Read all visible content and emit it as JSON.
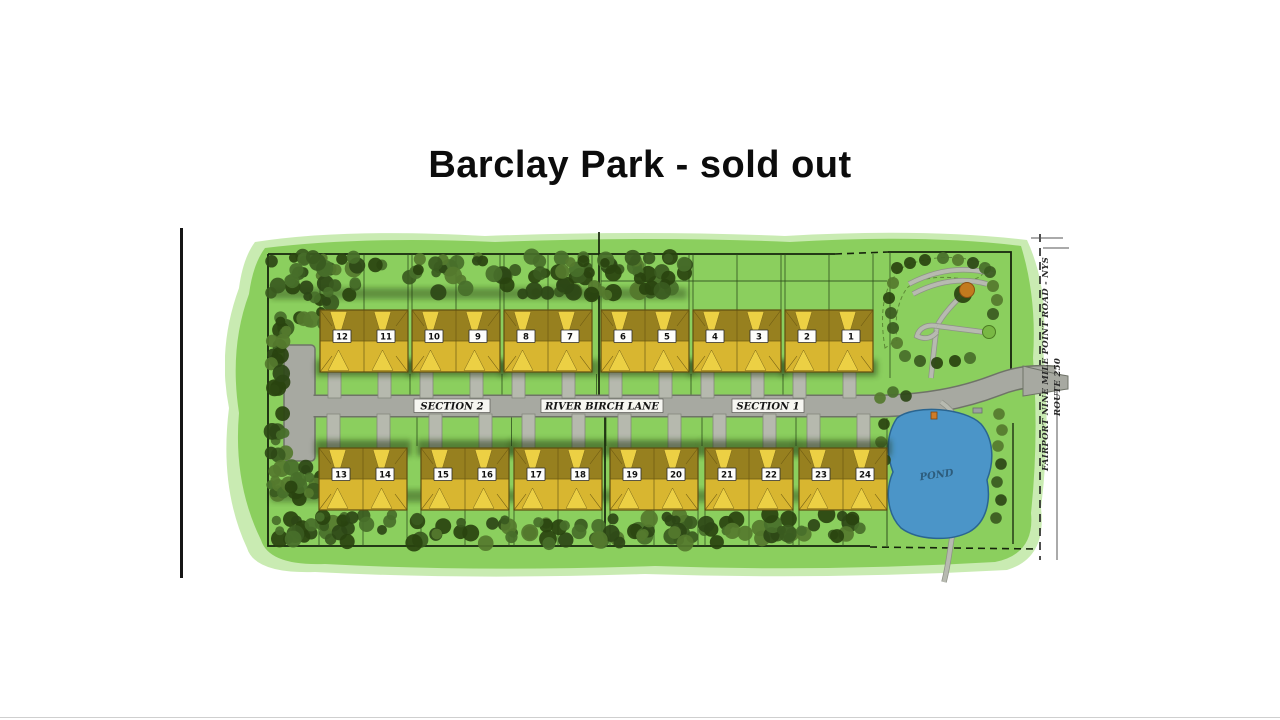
{
  "page": {
    "title": "Barclay Park -  sold out"
  },
  "map": {
    "street_label": "RIVER BIRCH LANE",
    "section_left_label": "SECTION 2",
    "section_right_label": "SECTION 1",
    "pond_label": "POND",
    "route_label_line1": "FAIRPORT NINE MILE POINT ROAD - NYS",
    "route_label_line2": "ROUTE 250",
    "buildings_top": [
      [
        12,
        11
      ],
      [
        10,
        9
      ],
      [
        8,
        7
      ],
      [
        6,
        5
      ],
      [
        4,
        3
      ],
      [
        2,
        1
      ]
    ],
    "buildings_bottom": [
      [
        13,
        14
      ],
      [
        15,
        16
      ],
      [
        17,
        18
      ],
      [
        19,
        20
      ],
      [
        21,
        22
      ],
      [
        23,
        24
      ]
    ]
  },
  "colors": {
    "grass": "#8bcf5e",
    "grass_halo": "#c6eaae",
    "road": "#a7a9a1",
    "road_edge": "#6f7368",
    "driveway": "#b6b9ae",
    "driveway_edge": "#84877c",
    "building_base": "#d8b630",
    "building_dark": "#97801f",
    "building_bright": "#ecd044",
    "building_outline": "#5f4e10",
    "pond": "#4b95c8",
    "pond_edge": "#2a6590",
    "boundary": "#16240c",
    "lot_line": "#2c4a1c",
    "shadow": "#1b310d",
    "orange_tree": "#c27a1e",
    "bush_green": "#79b844",
    "tree_greens": [
      "#2c4616",
      "#3a5a20",
      "#486f2a",
      "#29430f",
      "#55792e"
    ]
  }
}
